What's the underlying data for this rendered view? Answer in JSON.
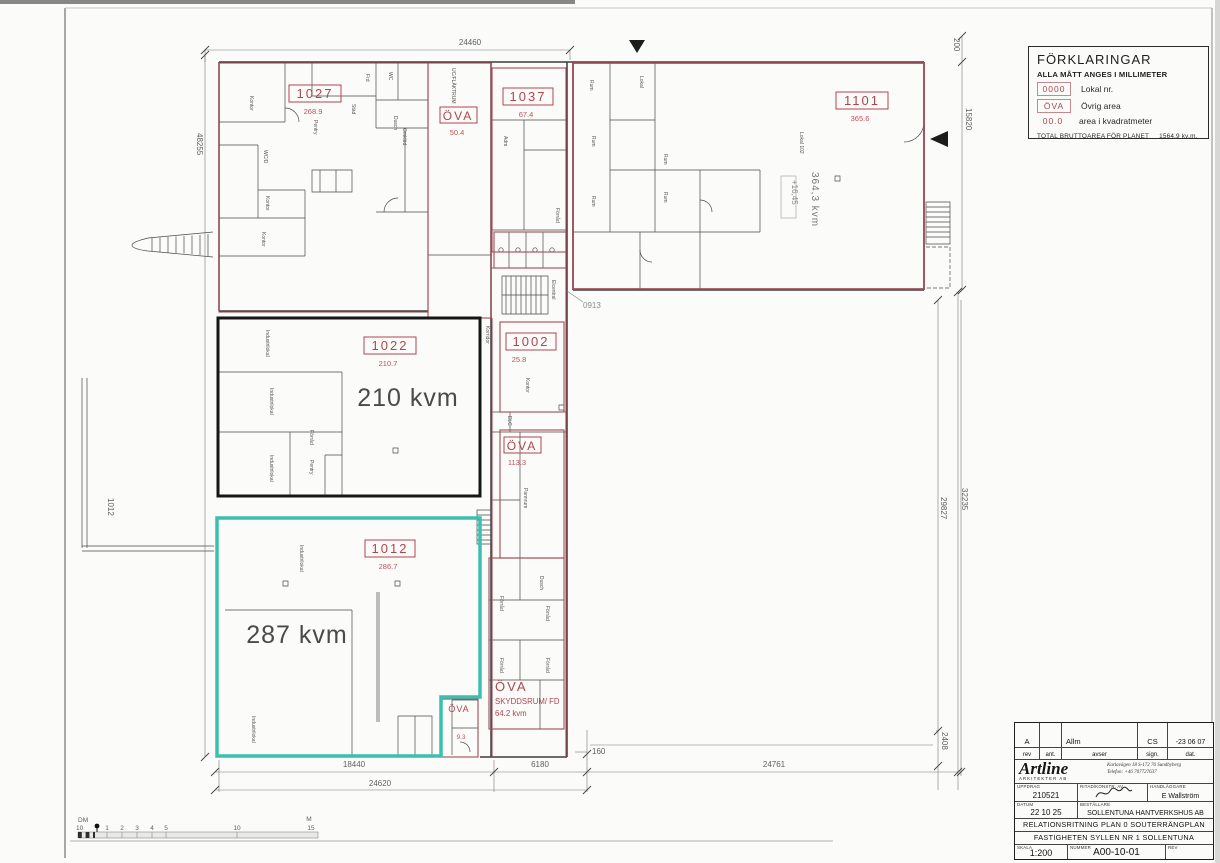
{
  "sheet": {
    "legend": {
      "title": "FÖRKLARINGAR",
      "note": "ALLA MÅTT ANGES I MILLIMETER",
      "items": [
        {
          "symbol": "0000",
          "label": "Lokal nr."
        },
        {
          "symbol": "ÖVA",
          "label": "Övrig area"
        },
        {
          "symbol": "00.0",
          "label": "area i kvadratmeter"
        }
      ],
      "total_label": "TOTAL BRUTTOAREA FÖR PLANET",
      "total_value": "1564,9  kv.m."
    },
    "titleblock": {
      "rev_entry": {
        "rev": "A",
        "avser": "Allm",
        "sign": "CS",
        "dat": "-23 06 07"
      },
      "headers": {
        "rev": "rev",
        "ant": "ant.",
        "avser": "avser",
        "sign": "sign.",
        "dat": "dat."
      },
      "firm_name": "Artline",
      "firm_sub": "ARKITEKTER AB",
      "firm_addr1": "Karlavägen 18     S-172 76 Sundbyberg",
      "firm_addr2": "Telefon:  +46 707727637",
      "uppdrag_label": "UPPDRAG",
      "uppdrag": "210521",
      "ritad_label": "RITAD/KONSTR. AV",
      "handlaggare_label": "HANDLÄGGARE",
      "handlaggare": "E Wallström",
      "datum_label": "DATUM",
      "datum": "22 10 25",
      "bestallare_label": "BESTÄLLARE",
      "bestallare": "SOLLENTUNA HANTVERKSHUS AB",
      "drawing_type": "RELATIONSRITNING  PLAN 0      SOUTERRÄNGPLAN",
      "property": "FASTIGHETEN SYLLEN NR 1 SOLLENTUNA",
      "skala_label": "SKALA",
      "skala": "1:200",
      "nummer_label": "NUMMER",
      "nummer": "A00-10-01",
      "rev_label": "REV"
    }
  },
  "plan": {
    "rooms": [
      {
        "id": "1027",
        "area": "268.9"
      },
      {
        "id": "1037",
        "area": "67.4"
      },
      {
        "id": "1101",
        "area": "365.6"
      },
      {
        "id": "1022",
        "area": "210.7"
      },
      {
        "id": "1002",
        "area": "25.8"
      },
      {
        "id": "1012",
        "area": "286.7"
      }
    ],
    "ova": [
      {
        "label": "ÖVA",
        "area": "50.4"
      },
      {
        "label": "ÖVA",
        "area": "113.3"
      },
      {
        "label": "ÖVA",
        "area": "9.3"
      },
      {
        "label": "ÖVA",
        "name": "SKYDDSRUM/ FD",
        "area": "64.2 kvm"
      }
    ],
    "area_notes": [
      "210 kvm",
      "287 kvm",
      "364,3 kvm",
      "+16,45"
    ],
    "dimensions": {
      "top": "24460",
      "left": "48255",
      "right_top_small": "200",
      "right_top": "15820",
      "right_outer": "32235",
      "right_inner": "29827",
      "bottom_1": "18440",
      "bottom_2": "6180",
      "bottom_3": "24761",
      "bottom_4": "24620",
      "bottom_small": "160",
      "bottom_right_small": "2408",
      "left_small": "1012",
      "note": "0913"
    },
    "small_labels": [
      "Kontor",
      "Pentry",
      "Städ",
      "Frd",
      "WC",
      "Dusch",
      "Omkläd",
      "WC/D",
      "Kontor",
      "Kontor",
      "UC/FLÄKTRUM",
      "Adm",
      "Förråd",
      "Rum",
      "Lokal",
      "Rum",
      "Rum",
      "Lokal 102",
      "Rum",
      "Rum",
      "Industrilokal",
      "Industrilokal",
      "Industrilokal",
      "Förråd",
      "Pentry",
      "Korridor",
      "Elcentral",
      "Kontor",
      "ELC",
      "Pannrum",
      "Förråd",
      "Dusch",
      "Förråd",
      "Förråd",
      "Förråd",
      "Industrilokal",
      "Industrilokal"
    ]
  },
  "scalebar": {
    "dm_label": "DM",
    "dm_value": "10",
    "ticks": [
      "1",
      "2",
      "3",
      "4",
      "5",
      "10"
    ],
    "m_label": "M",
    "m_value": "15"
  },
  "colors": {
    "room_outline": "#a34b55",
    "room_label": "#b0454f",
    "lokal_1022_outline": "#161616",
    "lokal_1012_outline": "#3bbfae",
    "walls": "#3d3d3d",
    "dimension_lines": "#777777"
  }
}
